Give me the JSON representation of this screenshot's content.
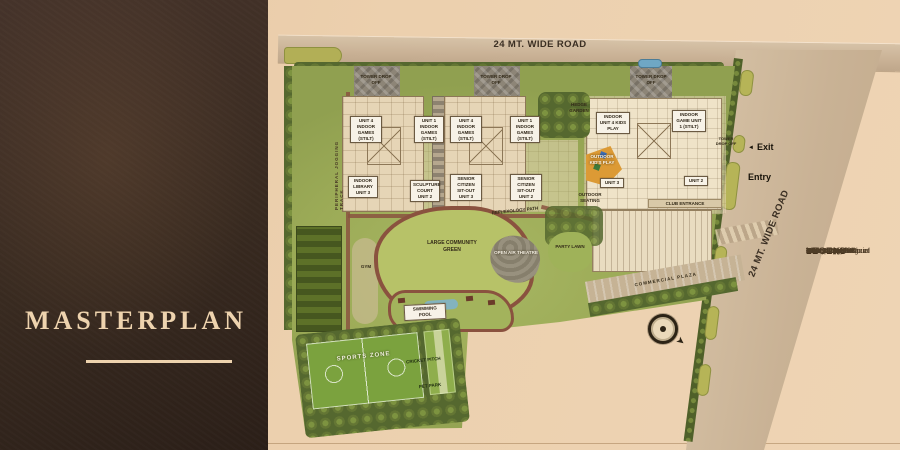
{
  "panel": {
    "title": "MASTERPLAN"
  },
  "map": {
    "top_road_label": "24 MT. WIDE ROAD",
    "right_road_label": "24 MT. WIDE ROAD",
    "exit_label": "Exit",
    "entry_label": "Entry",
    "jogging_track_label": "PERIPHERAL JOGGING TRACK",
    "drop_offs": [
      "TOWER DROP OFF",
      "TOWER DROP OFF",
      "TOWER DROP OFF",
      "TOWER DROP OFF"
    ],
    "unit_boxes_top": [
      "UNIT 4 INDOOR GAMES (STILT)",
      "UNIT 1 INDOOR GAMES (STILT)",
      "UNIT 4 INDOOR GAMES (STILT)",
      "UNIT 1 INDOOR GAMES (STILT)"
    ],
    "unit_boxes_mid": [
      "INDOOR LIBRARY UNIT 3",
      "SCULPTURE COURT UNIT 2",
      "SENIOR CITIZEN SIT-OUT UNIT 3",
      "SENIOR CITIZEN SIT-OUT UNIT 2"
    ],
    "labels": {
      "hedge_garden": "HEDGE GARDEN",
      "indoor_unit4_kids_play": "INDOOR UNIT 4 KIDS PLAY",
      "indoor_game_unit1": "INDOOR GAME UNIT 1 (STILT)",
      "outdoor_kids_play": "OUTDOOR KID'S PLAY",
      "outdoor_seating": "OUTDOOR SEATING",
      "unit_3": "UNIT 3",
      "unit_2": "UNIT 2",
      "club_entrance": "CLUB ENTRANCE",
      "reflexology_path": "REFLEXOLOGY PATH",
      "gym": "GYM",
      "large_community_green": "LARGE COMMUNITY GREEN",
      "open_air_theatre": "OPEN AIR THEATRE",
      "party_lawn": "PARTY LAWN",
      "swimming_pool": "SWIMMING POOL",
      "sports_zone": "SPORTS ZONE",
      "cricket_pitch": "CRICKET PITCH",
      "pet_park": "PET PARK",
      "commercial_plaza": "COMMERCIAL PLAZA"
    }
  },
  "legend": {
    "title": "LEGEND",
    "items": [
      {
        "key": "A1",
        "label": "Tower 4 BHK"
      },
      {
        "key": "A2",
        "label": "Tower-1 3 BHK"
      },
      {
        "key": "A3",
        "label": "Tower-2 3 BHK"
      },
      {
        "key": "B",
        "label": "Club + Commercial"
      },
      {
        "key": "C",
        "label": "Commercial Plaza"
      },
      {
        "key": "D",
        "label": "Club drop off"
      },
      {
        "key": "E",
        "label": "Tower Drop off"
      },
      {
        "key": "F",
        "label": "Lawn Area"
      },
      {
        "key": "G",
        "label": "O.A.T."
      },
      {
        "key": "H",
        "label": "Kid's play"
      },
      {
        "key": "J",
        "label": "Park Area"
      },
      {
        "key": "K",
        "label": "Multipurpose Court"
      },
      {
        "key": "L",
        "label": "Swimming Pool"
      },
      {
        "key": "M",
        "label": "Visitor's parking"
      }
    ]
  },
  "colors": {
    "panel": "#38291f",
    "accent": "#eed3ae",
    "paper": "#ecd0ae",
    "road": "#c9b195",
    "site_green": "#9cab57",
    "internal_road": "#8a5340"
  }
}
